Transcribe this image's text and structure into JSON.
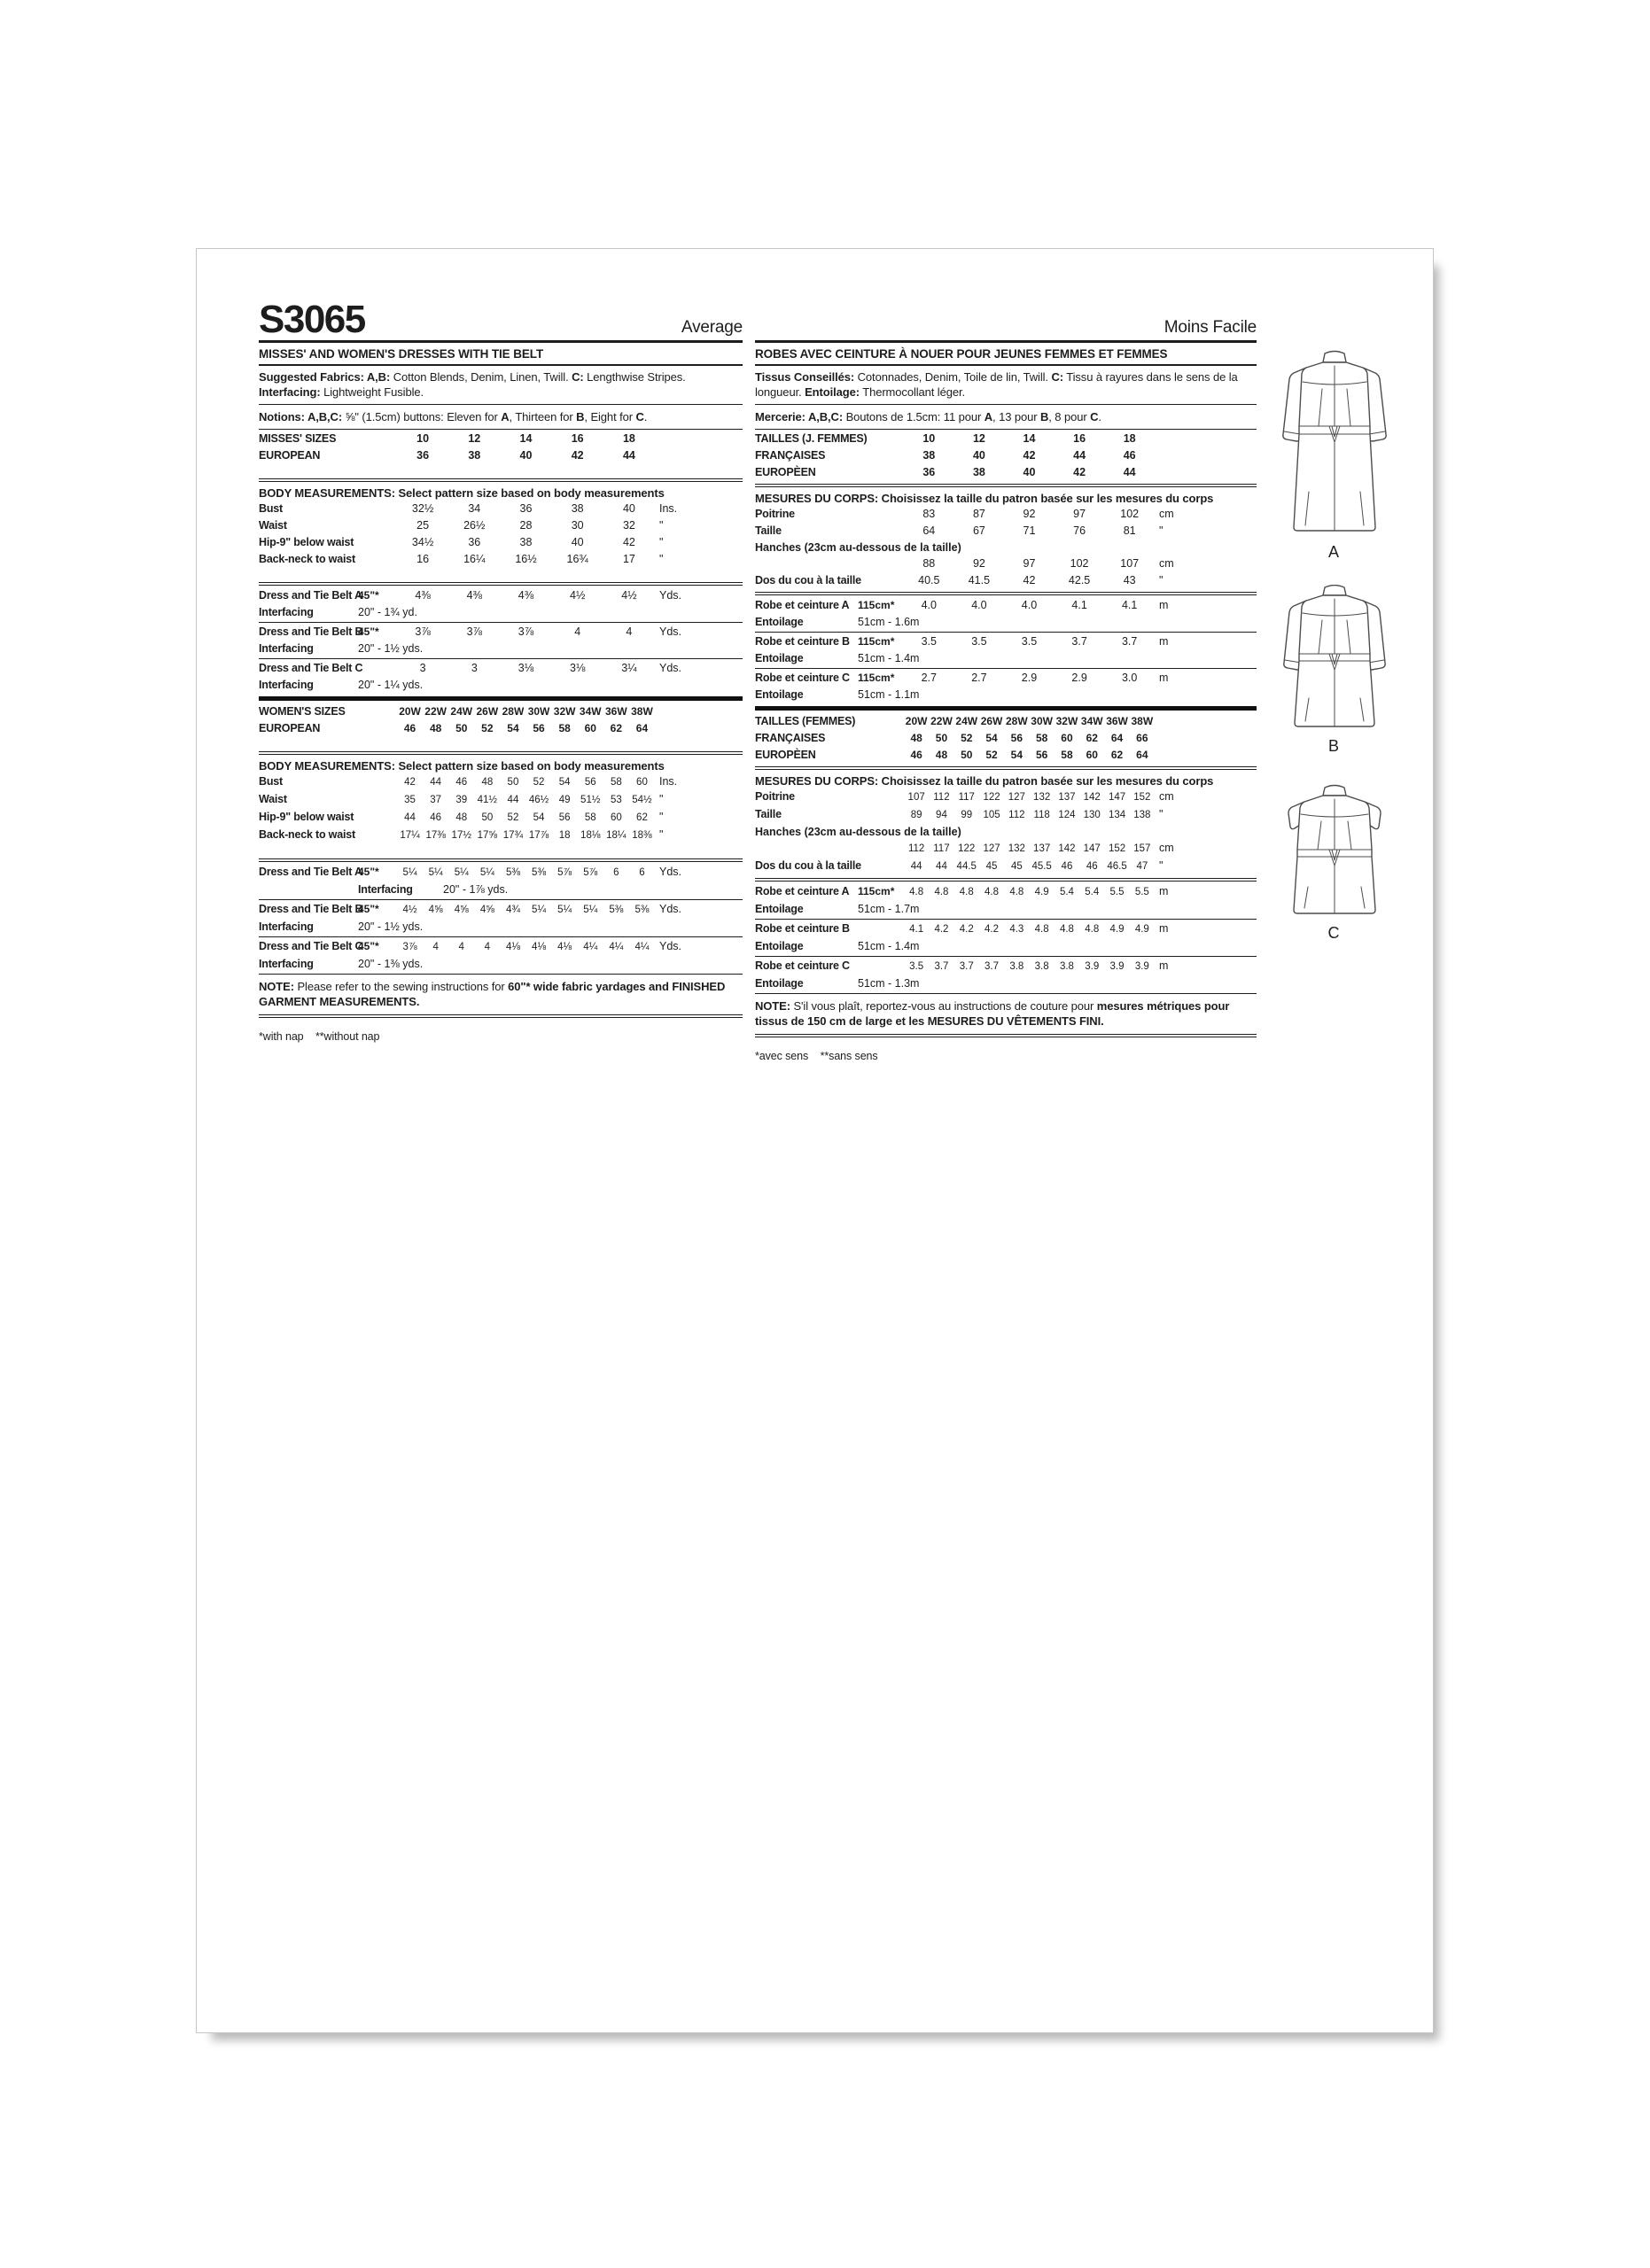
{
  "header": {
    "pattern": "S3065",
    "difficulty_en": "Average",
    "difficulty_fr": "Moins Facile"
  },
  "en": {
    "title": "MISSES' AND WOMEN'S DRESSES WITH TIE BELT",
    "footnote": "*with nap    **without nap",
    "rows": [
      {
        "type": "para",
        "segs": [
          {
            "t": "Suggested Fabrics: ",
            "b": 1
          },
          {
            "t": "A,B:",
            "b": 1
          },
          {
            "t": " Cotton Blends, Denim, Linen, Twill. "
          },
          {
            "t": "C:",
            "b": 1
          },
          {
            "t": " Lengthwise Stripes. "
          },
          {
            "t": "Interfacing:",
            "b": 1
          },
          {
            "t": " Lightweight Fusible."
          }
        ]
      },
      {
        "type": "rule"
      },
      {
        "type": "para",
        "segs": [
          {
            "t": "Notions: ",
            "b": 1
          },
          {
            "t": "A,B,C:",
            "b": 1
          },
          {
            "t": " ⅝\" (1.5cm) buttons: Eleven for "
          },
          {
            "t": "A",
            "b": 1
          },
          {
            "t": ", Thirteen for "
          },
          {
            "t": "B",
            "b": 1
          },
          {
            "t": ", Eight for "
          },
          {
            "t": "C",
            "b": 1
          },
          {
            "t": "."
          }
        ]
      },
      {
        "type": "rule"
      },
      {
        "type": "sizes",
        "label": "MISSES' SIZES",
        "values": [
          "10",
          "12",
          "14",
          "16",
          "18"
        ]
      },
      {
        "type": "sizes",
        "label": "EUROPEAN",
        "values": [
          "36",
          "38",
          "40",
          "42",
          "44"
        ]
      },
      {
        "type": "gap"
      },
      {
        "type": "rule2"
      },
      {
        "type": "heading",
        "text": "BODY MEASUREMENTS: Select pattern size based on body measurements"
      },
      {
        "type": "measure",
        "label": "Bust",
        "values": [
          "32½",
          "34",
          "36",
          "38",
          "40"
        ],
        "unit": "Ins."
      },
      {
        "type": "measure",
        "label": "Waist",
        "values": [
          "25",
          "26½",
          "28",
          "30",
          "32"
        ],
        "unit": "\""
      },
      {
        "type": "measure",
        "label": "Hip-9\" below waist",
        "values": [
          "34½",
          "36",
          "38",
          "40",
          "42"
        ],
        "unit": "\""
      },
      {
        "type": "measure",
        "label": "Back-neck to waist",
        "values": [
          "16",
          "16¼",
          "16½",
          "16¾",
          "17"
        ],
        "unit": "\""
      },
      {
        "type": "gap"
      },
      {
        "type": "rule2"
      },
      {
        "type": "yard",
        "label": "Dress and Tie Belt A",
        "width": "45\"*",
        "values": [
          "4⅜",
          "4⅜",
          "4⅜",
          "4½",
          "4½"
        ],
        "unit": "Yds."
      },
      {
        "type": "sub",
        "label": "Interfacing",
        "value": "20\" - 1¾ yd."
      },
      {
        "type": "rule"
      },
      {
        "type": "yard",
        "label": "Dress and Tie Belt B",
        "width": "45\"*",
        "values": [
          "3⅞",
          "3⅞",
          "3⅞",
          "4",
          "4"
        ],
        "unit": "Yds."
      },
      {
        "type": "sub",
        "label": "Interfacing",
        "value": "20\" - 1½ yds."
      },
      {
        "type": "rule"
      },
      {
        "type": "yard",
        "label": "Dress and Tie Belt C",
        "width": "",
        "values": [
          "3",
          "3",
          "3⅛",
          "3⅛",
          "3¼"
        ],
        "unit": "Yds."
      },
      {
        "type": "sub",
        "label": "Interfacing",
        "value": "20\" - 1¼ yds."
      },
      {
        "type": "ruleheavy"
      },
      {
        "type": "sizes",
        "label": "WOMEN'S SIZES",
        "values": [
          "20W",
          "22W",
          "24W",
          "26W",
          "28W",
          "30W",
          "32W",
          "34W",
          "36W",
          "38W"
        ]
      },
      {
        "type": "sizes",
        "label": "EUROPEAN",
        "values": [
          "46",
          "48",
          "50",
          "52",
          "54",
          "56",
          "58",
          "60",
          "62",
          "64"
        ]
      },
      {
        "type": "gap"
      },
      {
        "type": "rule2"
      },
      {
        "type": "heading",
        "text": "BODY MEASUREMENTS: Select pattern size based on body measurements"
      },
      {
        "type": "measure",
        "label": "Bust",
        "values": [
          "42",
          "44",
          "46",
          "48",
          "50",
          "52",
          "54",
          "56",
          "58",
          "60"
        ],
        "unit": "Ins."
      },
      {
        "type": "measure",
        "label": "Waist",
        "values": [
          "35",
          "37",
          "39",
          "41½",
          "44",
          "46½",
          "49",
          "51½",
          "53",
          "54½"
        ],
        "unit": "\""
      },
      {
        "type": "measure",
        "label": "Hip-9\" below waist",
        "values": [
          "44",
          "46",
          "48",
          "50",
          "52",
          "54",
          "56",
          "58",
          "60",
          "62"
        ],
        "unit": "\""
      },
      {
        "type": "measure",
        "label": "Back-neck to waist",
        "values": [
          "17¼",
          "17⅜",
          "17½",
          "17⅝",
          "17¾",
          "17⅞",
          "18",
          "18⅛",
          "18¼",
          "18⅜"
        ],
        "unit": "\""
      },
      {
        "type": "gap"
      },
      {
        "type": "rule2"
      },
      {
        "type": "yard",
        "label": "Dress and Tie Belt A",
        "width": "45\"*",
        "values": [
          "5¼",
          "5¼",
          "5¼",
          "5¼",
          "5⅜",
          "5⅜",
          "5⅞",
          "5⅞",
          "6",
          "6"
        ],
        "unit": "Yds."
      },
      {
        "type": "sub",
        "label": "Interfacing",
        "value": "20\" - 1⅞ yds.",
        "indent": true
      },
      {
        "type": "rule"
      },
      {
        "type": "yard",
        "label": "Dress and Tie Belt B",
        "width": "45\"*",
        "values": [
          "4½",
          "4⅝",
          "4⅝",
          "4⅝",
          "4¾",
          "5¼",
          "5¼",
          "5¼",
          "5⅜",
          "5⅜"
        ],
        "unit": "Yds."
      },
      {
        "type": "sub",
        "label": "Interfacing",
        "value": "20\" - 1½ yds."
      },
      {
        "type": "rule"
      },
      {
        "type": "yard",
        "label": "Dress and Tie Belt C",
        "width": "45\"*",
        "values": [
          "3⅞",
          "4",
          "4",
          "4",
          "4⅛",
          "4⅛",
          "4⅛",
          "4¼",
          "4¼",
          "4¼"
        ],
        "unit": "Yds."
      },
      {
        "type": "sub",
        "label": "Interfacing",
        "value": "20\" - 1⅜ yds."
      },
      {
        "type": "rule"
      },
      {
        "type": "para",
        "segs": [
          {
            "t": "NOTE:",
            "b": 1
          },
          {
            "t": " Please refer to the sewing instructions for "
          },
          {
            "t": "60\"* wide fabric yardages and FINISHED GARMENT MEASUREMENTS.",
            "b": 1
          }
        ]
      },
      {
        "type": "rule2"
      }
    ]
  },
  "fr": {
    "title": "ROBES AVEC CEINTURE À NOUER POUR JEUNES FEMMES ET FEMMES",
    "footnote": "*avec sens    **sans sens",
    "rows": [
      {
        "type": "para",
        "segs": [
          {
            "t": "Tissus Conseillés:",
            "b": 1
          },
          {
            "t": " Cotonnades, Denim, Toile de lin, Twill. "
          },
          {
            "t": "C:",
            "b": 1
          },
          {
            "t": " Tissu à rayures dans le sens de la longueur. "
          },
          {
            "t": "Entoilage:",
            "b": 1
          },
          {
            "t": " Thermocollant léger."
          }
        ]
      },
      {
        "type": "rule"
      },
      {
        "type": "para",
        "segs": [
          {
            "t": "Mercerie: ",
            "b": 1
          },
          {
            "t": "A,B,C:",
            "b": 1
          },
          {
            "t": " Boutons de 1.5cm: 11 pour "
          },
          {
            "t": "A",
            "b": 1
          },
          {
            "t": ", 13 pour "
          },
          {
            "t": "B",
            "b": 1
          },
          {
            "t": ", 8 pour "
          },
          {
            "t": "C",
            "b": 1
          },
          {
            "t": "."
          }
        ]
      },
      {
        "type": "rule"
      },
      {
        "type": "sizes",
        "label": "TAILLES (J. FEMMES)",
        "values": [
          "10",
          "12",
          "14",
          "16",
          "18"
        ]
      },
      {
        "type": "sizes",
        "label": "FRANÇAISES",
        "values": [
          "38",
          "40",
          "42",
          "44",
          "46"
        ]
      },
      {
        "type": "sizes",
        "label": "EUROPÈEN",
        "values": [
          "36",
          "38",
          "40",
          "42",
          "44"
        ]
      },
      {
        "type": "rule2"
      },
      {
        "type": "heading",
        "text": "MESURES DU CORPS: Choisissez la taille du patron basée sur les mesures du corps"
      },
      {
        "type": "measure",
        "label": "Poitrine",
        "values": [
          "83",
          "87",
          "92",
          "97",
          "102"
        ],
        "unit": "cm"
      },
      {
        "type": "measure",
        "label": "Taille",
        "values": [
          "64",
          "67",
          "71",
          "76",
          "81"
        ],
        "unit": "\""
      },
      {
        "type": "labelonly",
        "label": "Hanches (23cm au-dessous de la taille)"
      },
      {
        "type": "measure",
        "label": "",
        "values": [
          "88",
          "92",
          "97",
          "102",
          "107"
        ],
        "unit": "cm"
      },
      {
        "type": "measure",
        "label": "Dos du cou à la taille",
        "values": [
          "40.5",
          "41.5",
          "42",
          "42.5",
          "43"
        ],
        "unit": "\""
      },
      {
        "type": "rule2"
      },
      {
        "type": "yard",
        "label": "Robe et ceinture A",
        "width": "115cm*",
        "values": [
          "4.0",
          "4.0",
          "4.0",
          "4.1",
          "4.1"
        ],
        "unit": "m"
      },
      {
        "type": "sub",
        "label": "Entoilage",
        "value": "51cm - 1.6m"
      },
      {
        "type": "rule"
      },
      {
        "type": "yard",
        "label": "Robe et ceinture B",
        "width": "115cm*",
        "values": [
          "3.5",
          "3.5",
          "3.5",
          "3.7",
          "3.7"
        ],
        "unit": "m"
      },
      {
        "type": "sub",
        "label": "Entoilage",
        "value": "51cm - 1.4m"
      },
      {
        "type": "rule"
      },
      {
        "type": "yard",
        "label": "Robe et ceinture C",
        "width": "115cm*",
        "values": [
          "2.7",
          "2.7",
          "2.9",
          "2.9",
          "3.0"
        ],
        "unit": "m"
      },
      {
        "type": "sub",
        "label": "Entoilage",
        "value": "51cm - 1.1m"
      },
      {
        "type": "ruleheavy"
      },
      {
        "type": "sizes",
        "label": "TAILLES (FEMMES)",
        "values": [
          "20W",
          "22W",
          "24W",
          "26W",
          "28W",
          "30W",
          "32W",
          "34W",
          "36W",
          "38W"
        ]
      },
      {
        "type": "sizes",
        "label": "FRANÇAISES",
        "values": [
          "48",
          "50",
          "52",
          "54",
          "56",
          "58",
          "60",
          "62",
          "64",
          "66"
        ]
      },
      {
        "type": "sizes",
        "label": "EUROPÈEN",
        "values": [
          "46",
          "48",
          "50",
          "52",
          "54",
          "56",
          "58",
          "60",
          "62",
          "64"
        ]
      },
      {
        "type": "rule2"
      },
      {
        "type": "heading",
        "text": "MESURES DU CORPS: Choisissez la taille du patron basée sur les mesures du corps"
      },
      {
        "type": "measure",
        "label": "Poitrine",
        "values": [
          "107",
          "112",
          "117",
          "122",
          "127",
          "132",
          "137",
          "142",
          "147",
          "152"
        ],
        "unit": "cm"
      },
      {
        "type": "measure",
        "label": "Taille",
        "values": [
          "89",
          "94",
          "99",
          "105",
          "112",
          "118",
          "124",
          "130",
          "134",
          "138"
        ],
        "unit": "\""
      },
      {
        "type": "labelonly",
        "label": "Hanches (23cm au-dessous de la taille)"
      },
      {
        "type": "measure",
        "label": "",
        "values": [
          "112",
          "117",
          "122",
          "127",
          "132",
          "137",
          "142",
          "147",
          "152",
          "157"
        ],
        "unit": "cm"
      },
      {
        "type": "measure",
        "label": "Dos du cou à la taille",
        "values": [
          "44",
          "44",
          "44.5",
          "45",
          "45",
          "45.5",
          "46",
          "46",
          "46.5",
          "47"
        ],
        "unit": "\""
      },
      {
        "type": "rule2"
      },
      {
        "type": "yard",
        "label": "Robe et ceinture A",
        "width": "115cm*",
        "values": [
          "4.8",
          "4.8",
          "4.8",
          "4.8",
          "4.8",
          "4.9",
          "5.4",
          "5.4",
          "5.5",
          "5.5"
        ],
        "unit": "m"
      },
      {
        "type": "sub",
        "label": "Entoilage",
        "value": "51cm - 1.7m"
      },
      {
        "type": "rule"
      },
      {
        "type": "yard",
        "label": "Robe et ceinture B",
        "width": "",
        "values": [
          "4.1",
          "4.2",
          "4.2",
          "4.2",
          "4.3",
          "4.8",
          "4.8",
          "4.8",
          "4.9",
          "4.9"
        ],
        "unit": "m"
      },
      {
        "type": "sub",
        "label": "Entoilage",
        "value": "51cm - 1.4m"
      },
      {
        "type": "rule"
      },
      {
        "type": "yard",
        "label": "Robe et ceinture C",
        "width": "",
        "values": [
          "3.5",
          "3.7",
          "3.7",
          "3.7",
          "3.8",
          "3.8",
          "3.8",
          "3.9",
          "3.9",
          "3.9"
        ],
        "unit": "m"
      },
      {
        "type": "sub",
        "label": "Entoilage",
        "value": "51cm - 1.3m"
      },
      {
        "type": "rule"
      },
      {
        "type": "para",
        "segs": [
          {
            "t": "NOTE:",
            "b": 1
          },
          {
            "t": " S'il vous plaît, reportez-vous au instructions de couture pour "
          },
          {
            "t": "mesures métriques pour tissus de 150 cm de large et les MESURES DU VÊTEMENTS FINI.",
            "b": 1
          }
        ]
      },
      {
        "type": "rule2"
      }
    ]
  },
  "views": [
    {
      "label": "A"
    },
    {
      "label": "B"
    },
    {
      "label": "C"
    }
  ]
}
